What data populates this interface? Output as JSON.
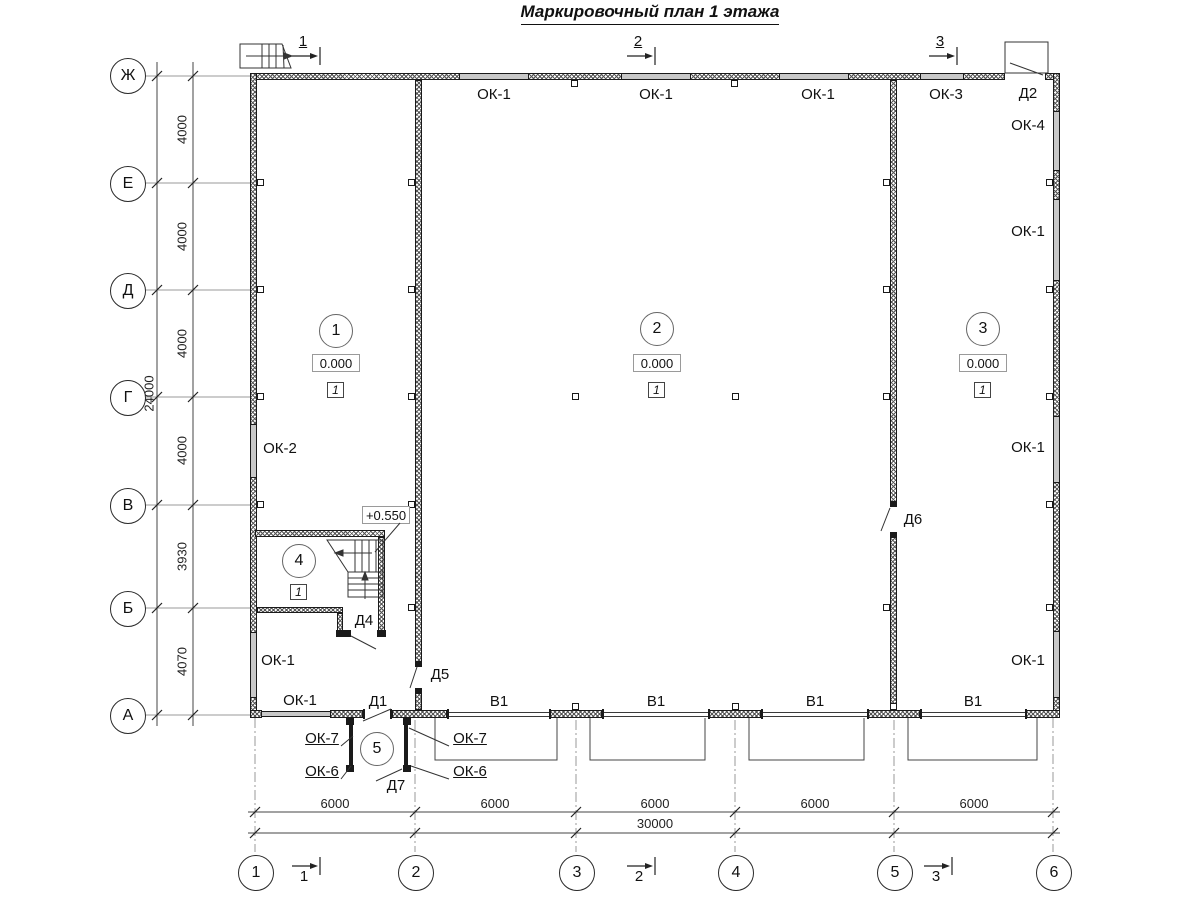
{
  "title": "Маркировочный план 1 этажа",
  "colors": {
    "line": "#1a1a1a",
    "axis_line": "#9a9a9a",
    "window_fill": "#c8c8c8"
  },
  "axis_rows": [
    "Ж",
    "Е",
    "Д",
    "Г",
    "В",
    "Б",
    "А"
  ],
  "axis_cols": [
    "1",
    "2",
    "3",
    "4",
    "5",
    "6"
  ],
  "dims": {
    "left_segments": [
      "4000",
      "4000",
      "4000",
      "4000",
      "3930",
      "4070"
    ],
    "left_total": "24000",
    "bottom_segments": [
      "6000",
      "6000",
      "6000",
      "6000",
      "6000"
    ],
    "bottom_total": "30000"
  },
  "sections_top": [
    "1",
    "2",
    "3"
  ],
  "sections_bottom": [
    "1",
    "2",
    "3"
  ],
  "rooms": [
    {
      "number": "1",
      "elevation": "0.000",
      "floor_type": "1"
    },
    {
      "number": "2",
      "elevation": "0.000",
      "floor_type": "1"
    },
    {
      "number": "3",
      "elevation": "0.000",
      "floor_type": "1"
    },
    {
      "number": "4",
      "floor_type": "1"
    },
    {
      "number": "5"
    }
  ],
  "stair_elevation": "+0.550",
  "marks": {
    "top_wall": [
      "ОК-1",
      "ОК-1",
      "ОК-1",
      "ОК-3",
      "Д2"
    ],
    "right_wall": [
      "ОК-4",
      "ОК-1",
      "ОК-1",
      "ОК-1"
    ],
    "left_wall": [
      "ОК-2",
      "ОК-1"
    ],
    "bottom_wall": [
      "ОК-1",
      "Д1",
      "В1",
      "В1",
      "В1",
      "В1"
    ],
    "interior_doors": [
      "Д4",
      "Д5",
      "Д6"
    ],
    "vestibule": [
      "ОК-7",
      "ОК-7",
      "ОК-6",
      "ОК-6",
      "Д7"
    ]
  }
}
